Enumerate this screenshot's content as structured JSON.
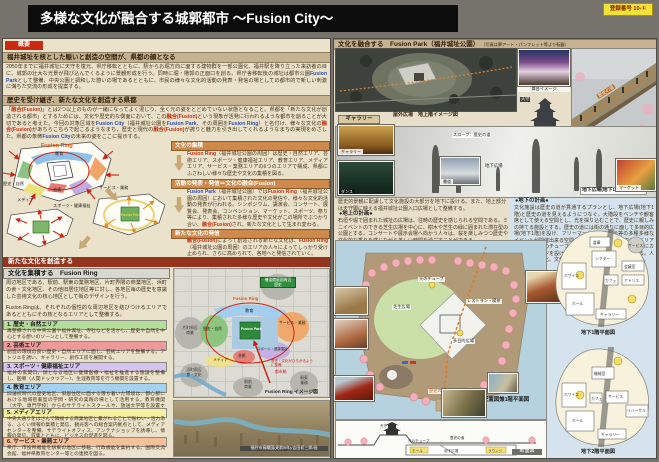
{
  "title": "多様な文化が融合する城郭都市 〜Fusion City〜",
  "badge": "登録番号 10-①",
  "left": {
    "tag": "概要",
    "s1_title": "福井城址を核とした賑いと創造の空間が、県都の顔となる",
    "s1": [
      "2050年までに福井城址に天守を復元、県庁移転とともに、駅からお堀方向に面する建物群を一部公園化、福井駅を降り立った来訪者の目に、城郭の壮大な光景が飛び込んでくるように景観形成を行う。同時に堀・櫓郭の正面口を創る。県庁舎移転後の城址は都市公園",
      "Fusion Park",
      "として整備、中央公園と調和した憩いの場であるとともに、市民の様々な文化的活動の発表・発信の場としての都市的で新しい刺激に満ちた交流の形成を提案する。"
    ],
    "s2_title": "歴史を受け継ぎ、新たな文化を創造する県都",
    "s2": [
      "「",
      "融合(Fusion)",
      "」とは2つ以上のものが一緒になってよく混じり、全く元の姿をとどめていない状態となること。県都を「新たな文化が創造される都市」とするためには、文化や歴史的な側面において、この",
      "融合(Fusion)",
      "という現象が活発に行われるような都市を創ることが大切であると考えた。今回の対象区域を",
      "Fusion City",
      "（福井城址公園を",
      "Fusion Park",
      "、その周囲を",
      "Fusion Ring",
      "）と名付け、様々な文化の",
      "融合(Fusion)",
      "があちらこちらで起こるようなまち、歴史と現代の",
      "融合(Fusion)",
      "が誇りと魅力を引き出してくれるようなまちの実現をめざした。県都の象徴",
      "Fusion City",
      "の未来の姿をここに提示する。"
    ],
    "dia": {
      "ring": "Fusion Ring",
      "park": "Fusion Park",
      "z1": "教育",
      "z2": "サービス・業務",
      "z3": "歴史・自然",
      "z4": "芸術",
      "z5": "スポーツ・健康福祉",
      "z6": "メディア"
    },
    "box1_t": "文化の集積",
    "box1": [
      "Fusion Ring",
      "（福井城址公園の周囲）は歴史・自然エリア、芸術エリア、スポーツ・健康福祉エリア、教育エリア、メディアエリア、サービス・業務エリアの6つのエリアで構成、県都にふさわしい様々な歴史や文化の集積を図る。"
    ],
    "box2_t": "活動の発表・発信＝文化の融合(Fusion)",
    "box2": [
      "Fusion Park",
      "（福井城址公園）では",
      "Fusion Ring",
      "（福井城址公園の周囲）において集積された文化の発信や、様々な文化的活動の発表が行われる。シンポジウム、講演会、コンサート、展覧会、発表会、コンベンション、マーケット、スポーツ、祭り等により、集積された多様な歴史や文化がこの場所でぶつかり合い、",
      "融合(Fusion)",
      "され、新たな文化として生まれ変わる。"
    ],
    "box3_t": "新たな文化の発信",
    "box3": [
      "融合(Fusion)",
      "によって創造される新たな文化は、",
      "Fusion Ring",
      "（福井城址公園の周囲）のエリアの人々によってしっかり受け止められ、さらに高められて、各地へと発信されていく。"
    ],
    "create_h": "新たな文化を創造する",
    "ring_h": "文化を集積する　Fusion Ring",
    "ring_p1": "周辺地区である、駅前、駅東の業務地区、片町界隈の商業地区、浜町の食・文化地区、その他旧居住地区等に対し、各地区毎の歴史を意識した芸術文化の核心地区として街のデザインを行う。",
    "ring_p2": "Fusion Ringは、それぞれの個性的な周辺地区を結びつけるエリアであるとともにその核となるエリアとして整備する。",
    "areas": [
      {
        "t": "1. 歴史・自然エリア",
        "b": "再整備される中央公園や福井城址、寺社などを活かし、歴史や自然を中心とする憩いのゾーンとして整備する。"
      },
      {
        "t": "2. 芸術エリア",
        "b": "創造の環境の良い歴史・自然エリアに面し、芸術エリアを整備する。アトリエを誘い、ギャラリー、創作工房を展開する。"
      },
      {
        "t": "3. スポーツ・健康福祉エリア",
        "b": "福井の玄関口、顔となる地区に健康医療・福祉を推進する施設を整備し、医療（人間ドックツアー）、生涯教育等を行う機関を設置する。"
      },
      {
        "t": "4. 教育エリア",
        "b": "旧藩校時代の歴史地区、旧居住区に面する落ち着いた環境は、都心部における地域密着型の学問・研究の実践の場として活用する。教育機関（大学、専門学校）からのサテライトスクールや、放送大学等を設置する。"
      },
      {
        "t": "5. メディアエリア",
        "b": "中央大通りをはさんで隣接する商業地区と繋がれることで賑わい・活力ある、ふくい情報の集積と発信、観光客への総合案内拠点として、メディアセンターを整備、サテライトオフィス、アンテナショップを誘導し、情報の発信、収集とともに、ビジネスの促進を図る。"
      },
      {
        "t": "6. サービス・業務エリア",
        "b": "県庁、市役所機能を駅東の地区に移転、行政機能を集約する。国際交流会館、福井県教育センター等との連携を図る。"
      }
    ]
  },
  "map": {
    "yokokan": "養浩館庭園周辺",
    "yokokan2": "歴史",
    "ring": "Fusion Ring",
    "park": "Fusion Park",
    "z_edu": "教育",
    "z_svc": "サービス・業務",
    "z_his": "歴史・自然",
    "z_art": "芸術",
    "z_spo": "スポーツ・健康福祉",
    "z_med": "メディア",
    "c1": "片町周辺",
    "c1b": "商業",
    "c2": "浜町周辺",
    "c2b": "食・文化",
    "c3": "駅前",
    "c3b": "商業",
    "c4": "駅東",
    "c4b": "業務",
    "axis1": "歴史・文化がひろがるように整備",
    "axis2": "都市軸",
    "caption": "Fusion Ring イメージ図",
    "aerial_caption": "福井市鳥瞰図(昭和9年)/吉田初三郎/画"
  },
  "right": {
    "header": "文化を融合する　Fusion Park（福井城址公園）",
    "note": "（写真は夢アート・パンフレット等より転載）",
    "plaza_caption": "屋外広場　地上階イメージ図",
    "stage_caption": "舞台イメージ",
    "road": "歴史の道",
    "tenshu": "天守",
    "gallery_tag": "ギャラリー",
    "ph_gallery": "ギャラリー",
    "ph_dance": "ダンス",
    "ph_sho": "書道",
    "ph_market": "マーケット",
    "slope_note": "スロープ：歴史の道",
    "chika": "地下広場",
    "mid_caption": "地下広場(地下1階)イメージ図",
    "intro": "歴史的景観に配慮して文化施設の大部分を地下に設ける。また、地上部分は天守閣に映える福井城址公園入口広場として整備する。",
    "ground_t": "●地上の計画●",
    "ground_b": "石垣や堀で囲まれた城址の広場は、往時の歴史を感じられる空間である。ミニイベントのできる芝生広場を中心に、樹木や芝生の緑に囲まれた滞在型の公園とする。コンサートや展示会場へ向かう人々は、桜を楽しみつつ歴史や文化的な香りを感じながら美しい時間を過ごすことができる。",
    "under_t": "●地下の計画●",
    "under_b": "文化施設は歴史の道が貫通するプランとし、地下広場(地下1階)と歴史の道を見えるようにつなぐ。大階段をベンチや観客席として使える空間とし、光を採り込むことで、歴史に親しみの持てる施設とする。歴史の道には街の通りに面して多目的広場(地下1階)を設け、フリーマーケットや展示等の多種多様なイベントが開催出来る空間として整備する。施設内の各エリアの中心には光のチューブを設け、上下をつなぐ。移動端部にカフェやラウンジを設けることで、様々なつながりをつくる。人と人・人と文化、文化と文化のつながりを生み出していく。",
    "sp": {
      "caption": "配置図兼1階平面図",
      "lawn": "芝生広場",
      "tube": "光のチューブ",
      "road": "歴史の道",
      "tamoku": "多目的広場",
      "rest": "レストラン・喫茶"
    },
    "b1": {
      "caption": "地下1階平面図",
      "r1": "倉庫",
      "r2": "シアター",
      "r3": "ホワイエ",
      "r4": "ホール",
      "r5": "会議室",
      "r6": "アトリエ",
      "r7": "カフェ",
      "r8": "ギャラリー",
      "r9": "サービス"
    },
    "b2": {
      "caption": "地下2階平面図",
      "r1": "機械室",
      "r2": "ホワイエ",
      "r3": "ホール",
      "r4": "サービス",
      "r5": "カフェ",
      "r6": "ギャラリー",
      "r7": "リハーサル"
    },
    "sec": {
      "caption": "断面図",
      "tenshu": "天守",
      "tube": "光のチューブ",
      "road": "歴史の道",
      "plaza": "地下広場",
      "hall": "ホール",
      "lounge": "ラウンジ"
    }
  }
}
